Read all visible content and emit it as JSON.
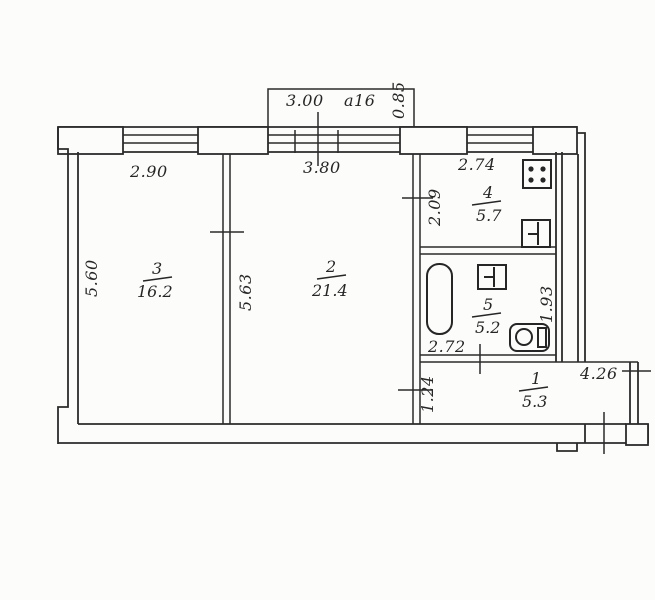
{
  "page": {
    "title": "apartment-floor-plan",
    "background": "#fcfcfb",
    "ink": "#2b2b2b"
  },
  "balcony": {
    "width": "3.00",
    "code": "a16",
    "depth": "0.85"
  },
  "rooms": {
    "living": {
      "number": "3",
      "area": "16.2",
      "width": "2.90",
      "height": "5.60"
    },
    "main": {
      "number": "2",
      "area": "21.4",
      "width": "3.80",
      "height": "5.63"
    },
    "kitchen": {
      "number": "4",
      "area": "5.7",
      "width": "2.74",
      "height": "2.09"
    },
    "bathroom": {
      "number": "5",
      "area": "5.2",
      "width": "2.72",
      "height": "1.93"
    },
    "entry_hall": {
      "number": "1",
      "area": "5.3",
      "width": "4.26",
      "height": "1.24"
    }
  },
  "icons": {
    "stove": "stove-icon",
    "kitchen_sink": "sink-icon",
    "bathtub": "bathtub-icon",
    "bathroom_sink": "sink-icon",
    "toilet": "toilet-icon"
  }
}
